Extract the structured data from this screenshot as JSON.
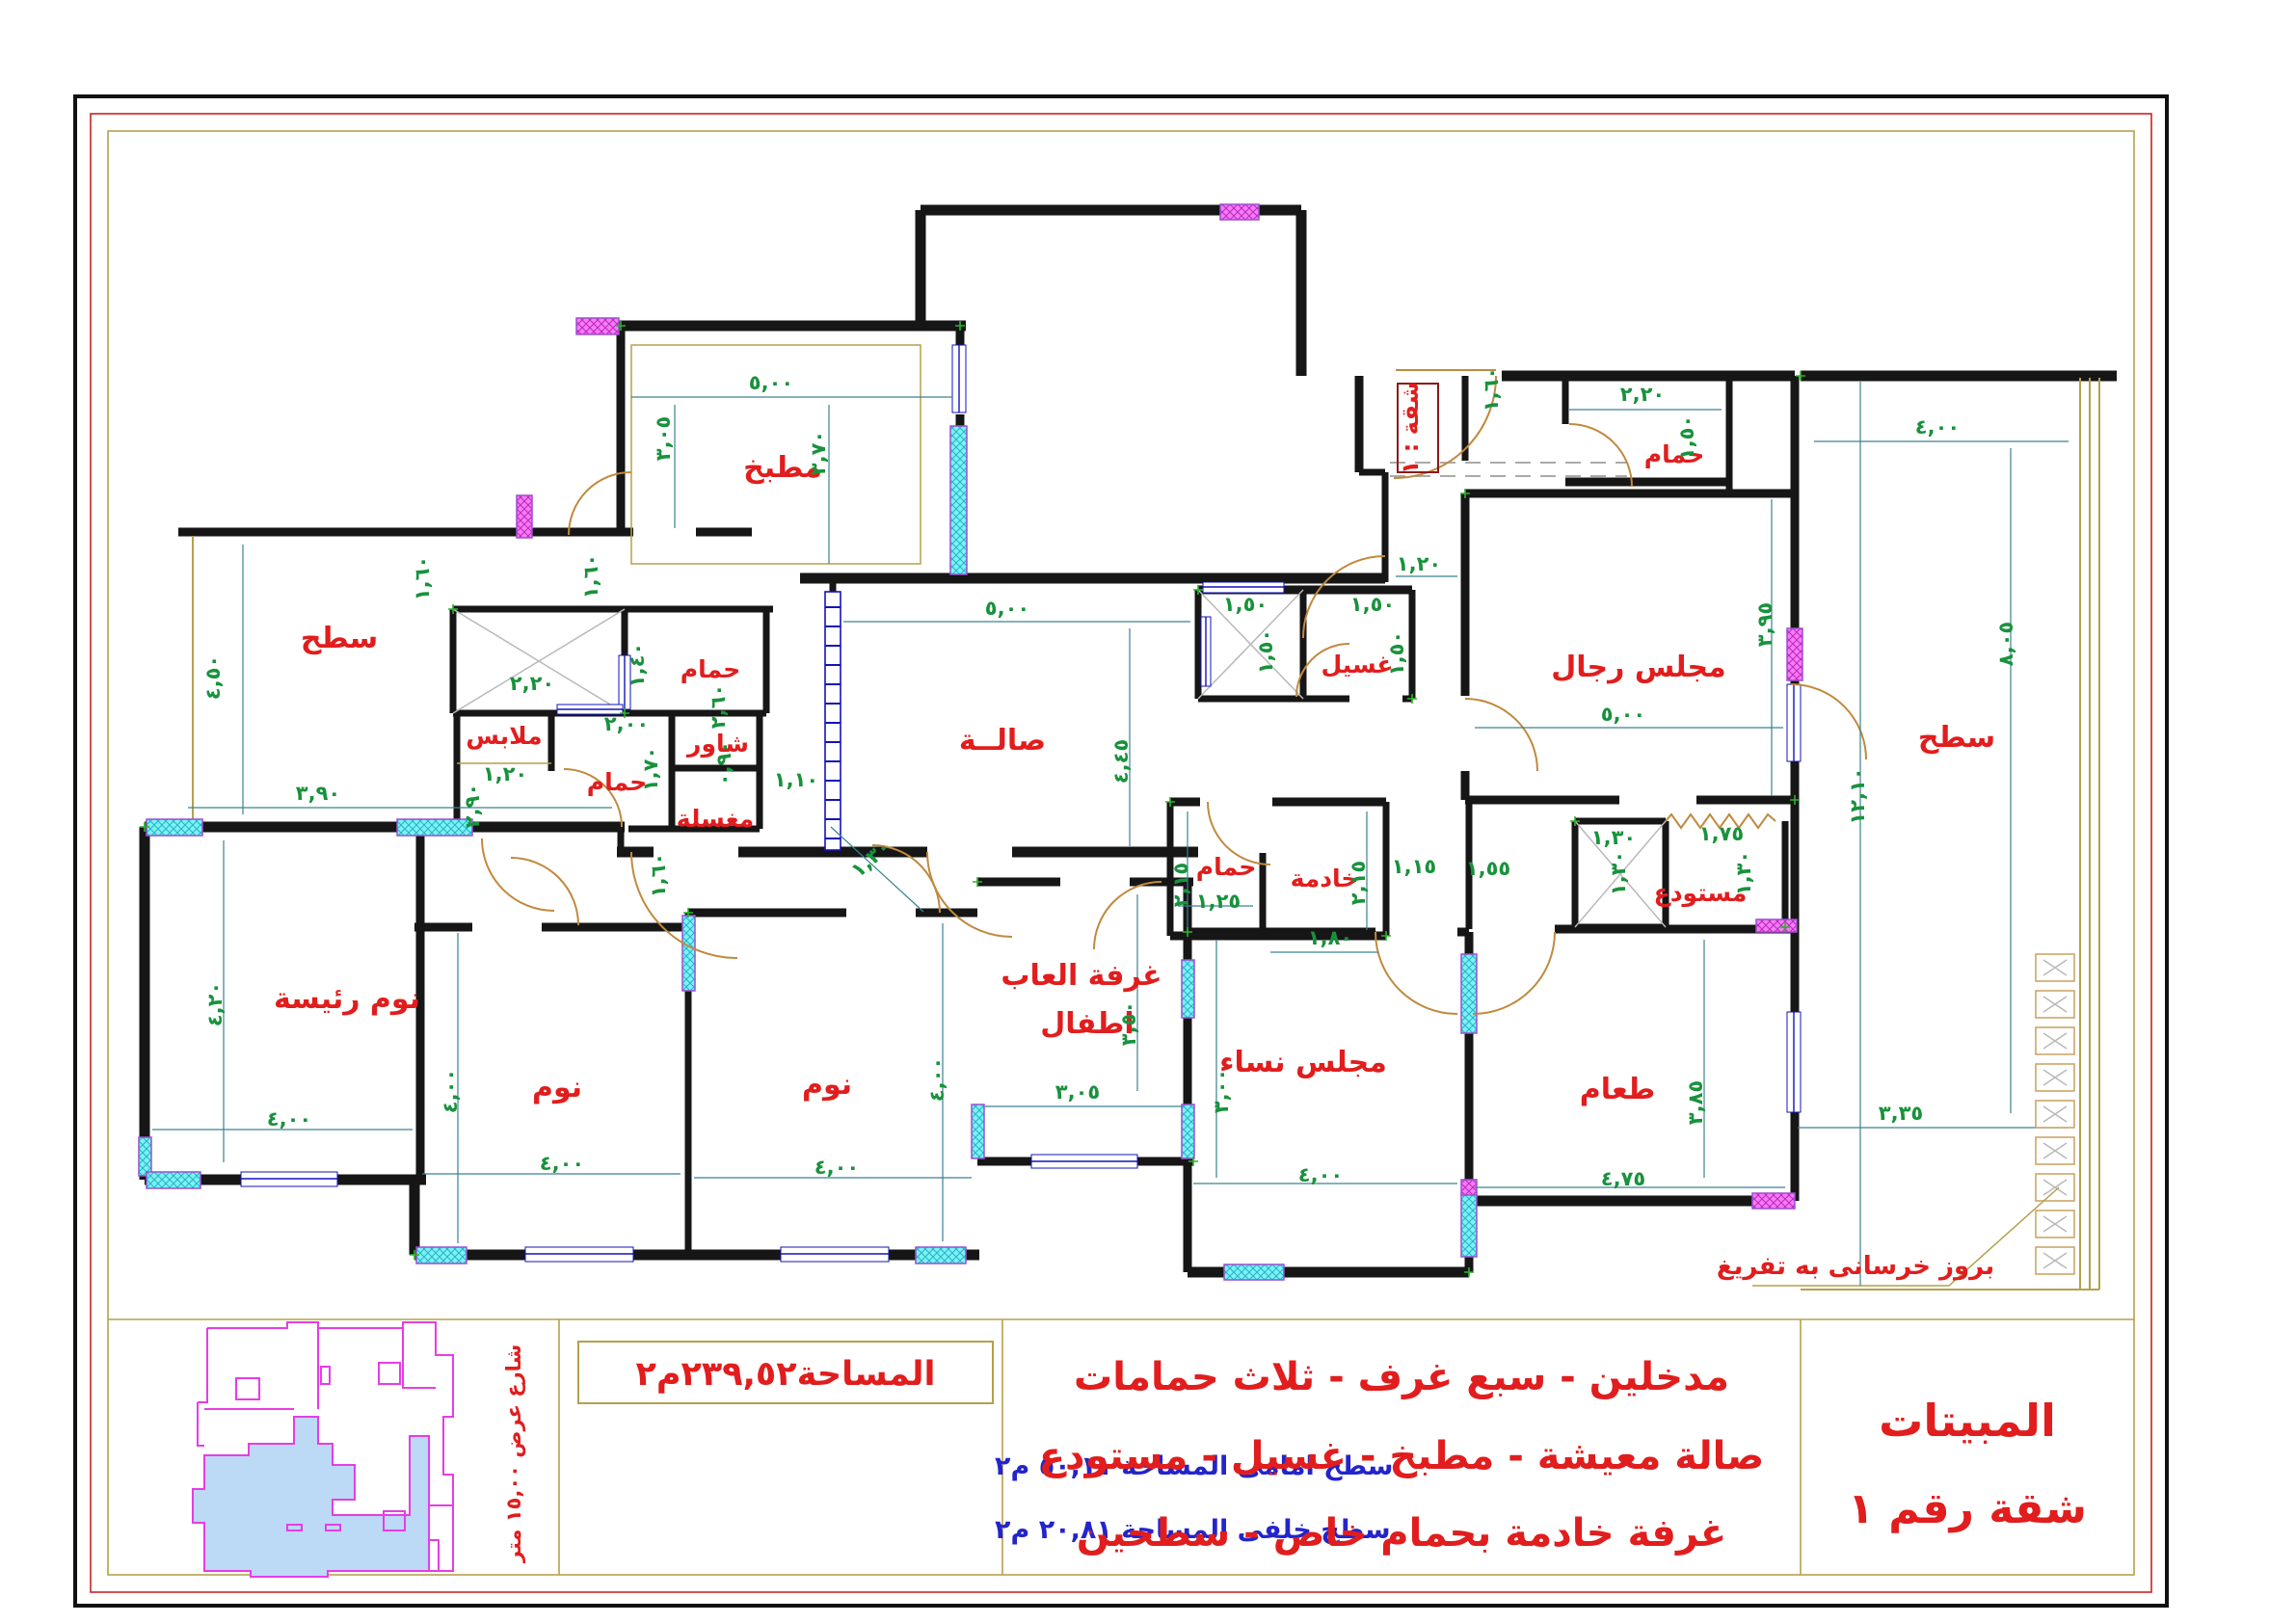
{
  "title_block": {
    "line1": "المبيتات",
    "line2": "شقة رقم ١"
  },
  "description": {
    "line1": "مدخلين  -  سبع غرف  -  ثلاث حمامات",
    "line2": "صالة معيشة - مطبخ -  غسيل - مستودع",
    "line3": "غرفة خادمة بحمام خاص  -  سطحين"
  },
  "area_box": {
    "text": "المساحة٢٣٩,٥٢م٢"
  },
  "roof_areas": {
    "front": "سطح امامى المساحة ٥٠,١١ م٢",
    "back": "سطح خلفى المساحة ٢٠,٨١ م٢"
  },
  "site": {
    "street": "شارع عرض ١٥,٠٠ متر"
  },
  "plan": {
    "apartment_tag": "شقة : ١",
    "annotation": "بروز خرسانى به تفريغ",
    "rooms": [
      {
        "id": "roof-left",
        "label": "سطح"
      },
      {
        "id": "kitchen",
        "label": "مطبخ"
      },
      {
        "id": "bath-upper",
        "label": "حمام"
      },
      {
        "id": "closet",
        "label": "ملابس"
      },
      {
        "id": "bath-mid",
        "label": "حمام"
      },
      {
        "id": "shower",
        "label": "شاور"
      },
      {
        "id": "washbasin",
        "label": "مغسلة"
      },
      {
        "id": "hall",
        "label": "صالــة"
      },
      {
        "id": "laundry",
        "label": "غسيل"
      },
      {
        "id": "men-majlis",
        "label": "مجلس رجال"
      },
      {
        "id": "bath-entry",
        "label": "حمام"
      },
      {
        "id": "maid",
        "label": "خادمة"
      },
      {
        "id": "bath-maid",
        "label": "حمام"
      },
      {
        "id": "playroom-1",
        "label": "غرفة العاب"
      },
      {
        "id": "playroom-2",
        "label": "اطفال"
      },
      {
        "id": "bedroom-c",
        "label": "نوم"
      },
      {
        "id": "bedroom-l",
        "label": "نوم"
      },
      {
        "id": "master-bedroom",
        "label": "نوم رئيسة"
      },
      {
        "id": "women-majlis",
        "label": "مجلس نساء"
      },
      {
        "id": "dining",
        "label": "طعام"
      },
      {
        "id": "store",
        "label": "مستودع"
      },
      {
        "id": "roof-right",
        "label": "سطح"
      }
    ],
    "dims": [
      {
        "t": "٤,٥٠"
      },
      {
        "t": "٣,٩٠"
      },
      {
        "t": "٢,٢٠"
      },
      {
        "t": "١,٤٠"
      },
      {
        "t": "٢,٠٠"
      },
      {
        "t": "١,٢٠"
      },
      {
        "t": "١,٧٠"
      },
      {
        "t": "٢,٩٠"
      },
      {
        "t": "٠,٩٠"
      },
      {
        "t": "٢,٦٠"
      },
      {
        "t": "١,١٠"
      },
      {
        "t": "٥,٠٠"
      },
      {
        "t": "٣,٠٥"
      },
      {
        "t": "٣,٧٠"
      },
      {
        "t": "١,٦٠"
      },
      {
        "t": "١,٦٠"
      },
      {
        "t": "٥,٠٠"
      },
      {
        "t": "٤,٤٥"
      },
      {
        "t": "١,٥٠"
      },
      {
        "t": "١,٥٠"
      },
      {
        "t": "١,٥٠"
      },
      {
        "t": "١,٥٠"
      },
      {
        "t": "١,٣٠"
      },
      {
        "t": "١,٦٠"
      },
      {
        "t": "٢,٢٠"
      },
      {
        "t": "١,٥٠"
      },
      {
        "t": "١,٢٠"
      },
      {
        "t": "٥,٠٠"
      },
      {
        "t": "٣,٩٥"
      },
      {
        "t": "٤,٠٠"
      },
      {
        "t": "٨,٠٥"
      },
      {
        "t": "١٢,١٠"
      },
      {
        "t": "٣,٣٥"
      },
      {
        "t": "٢,١٥"
      },
      {
        "t": "١,٢٥"
      },
      {
        "t": "٢,١٥"
      },
      {
        "t": "١,٨٠"
      },
      {
        "t": "١,١٥"
      },
      {
        "t": "١,٥٥"
      },
      {
        "t": "٣,٠٥"
      },
      {
        "t": "٣,٥٠"
      },
      {
        "t": "٤,٠٠"
      },
      {
        "t": "٤,٠٠"
      },
      {
        "t": "٤,٠٠"
      },
      {
        "t": "٤,٠٠"
      },
      {
        "t": "٤,٢٠"
      },
      {
        "t": "٤,٠٠"
      },
      {
        "t": "٤,٠٠"
      },
      {
        "t": "٣,٠٠"
      },
      {
        "t": "٤,٧٥"
      },
      {
        "t": "٣,٨٥"
      },
      {
        "t": "١,٧٥"
      },
      {
        "t": "١,٣٠"
      },
      {
        "t": "١,٣٠"
      },
      {
        "t": "١,٣٠"
      },
      {
        "t": "١,٦٠"
      }
    ]
  },
  "colors": {
    "wall": "#161616",
    "dim_text": "#18923c",
    "dim_line": "#3a8290",
    "room_text": "#e11d1d",
    "door": "#c08a3e",
    "window_cyan": "#7ff0f5",
    "window_magenta": "#f07ff0",
    "glazing_blue": "#1313bb",
    "border_tan": "#b5a04c",
    "border_red": "#cc2222",
    "site_outline": "#e63de6",
    "site_fill": "#bcd9f5",
    "blue_text": "#2424cc"
  }
}
